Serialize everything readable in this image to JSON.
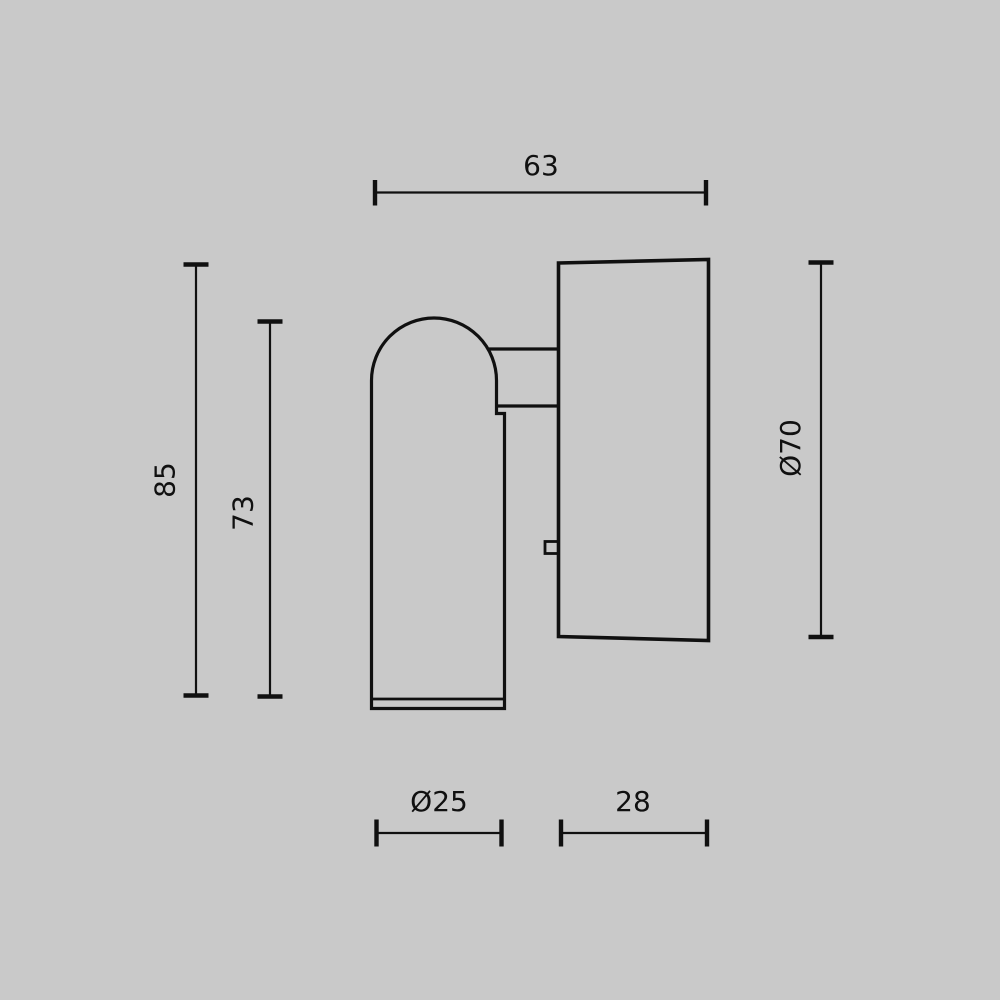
{
  "theme": {
    "background": "#c9c9c9",
    "line_color": "#101010"
  },
  "dimensions": {
    "width_top": {
      "label": "63"
    },
    "overall_height": {
      "label": "85"
    },
    "head_height": {
      "label": "73"
    },
    "base_diameter": {
      "label": "Ø70"
    },
    "head_diameter": {
      "label": "Ø25"
    },
    "base_depth": {
      "label": "28"
    }
  }
}
